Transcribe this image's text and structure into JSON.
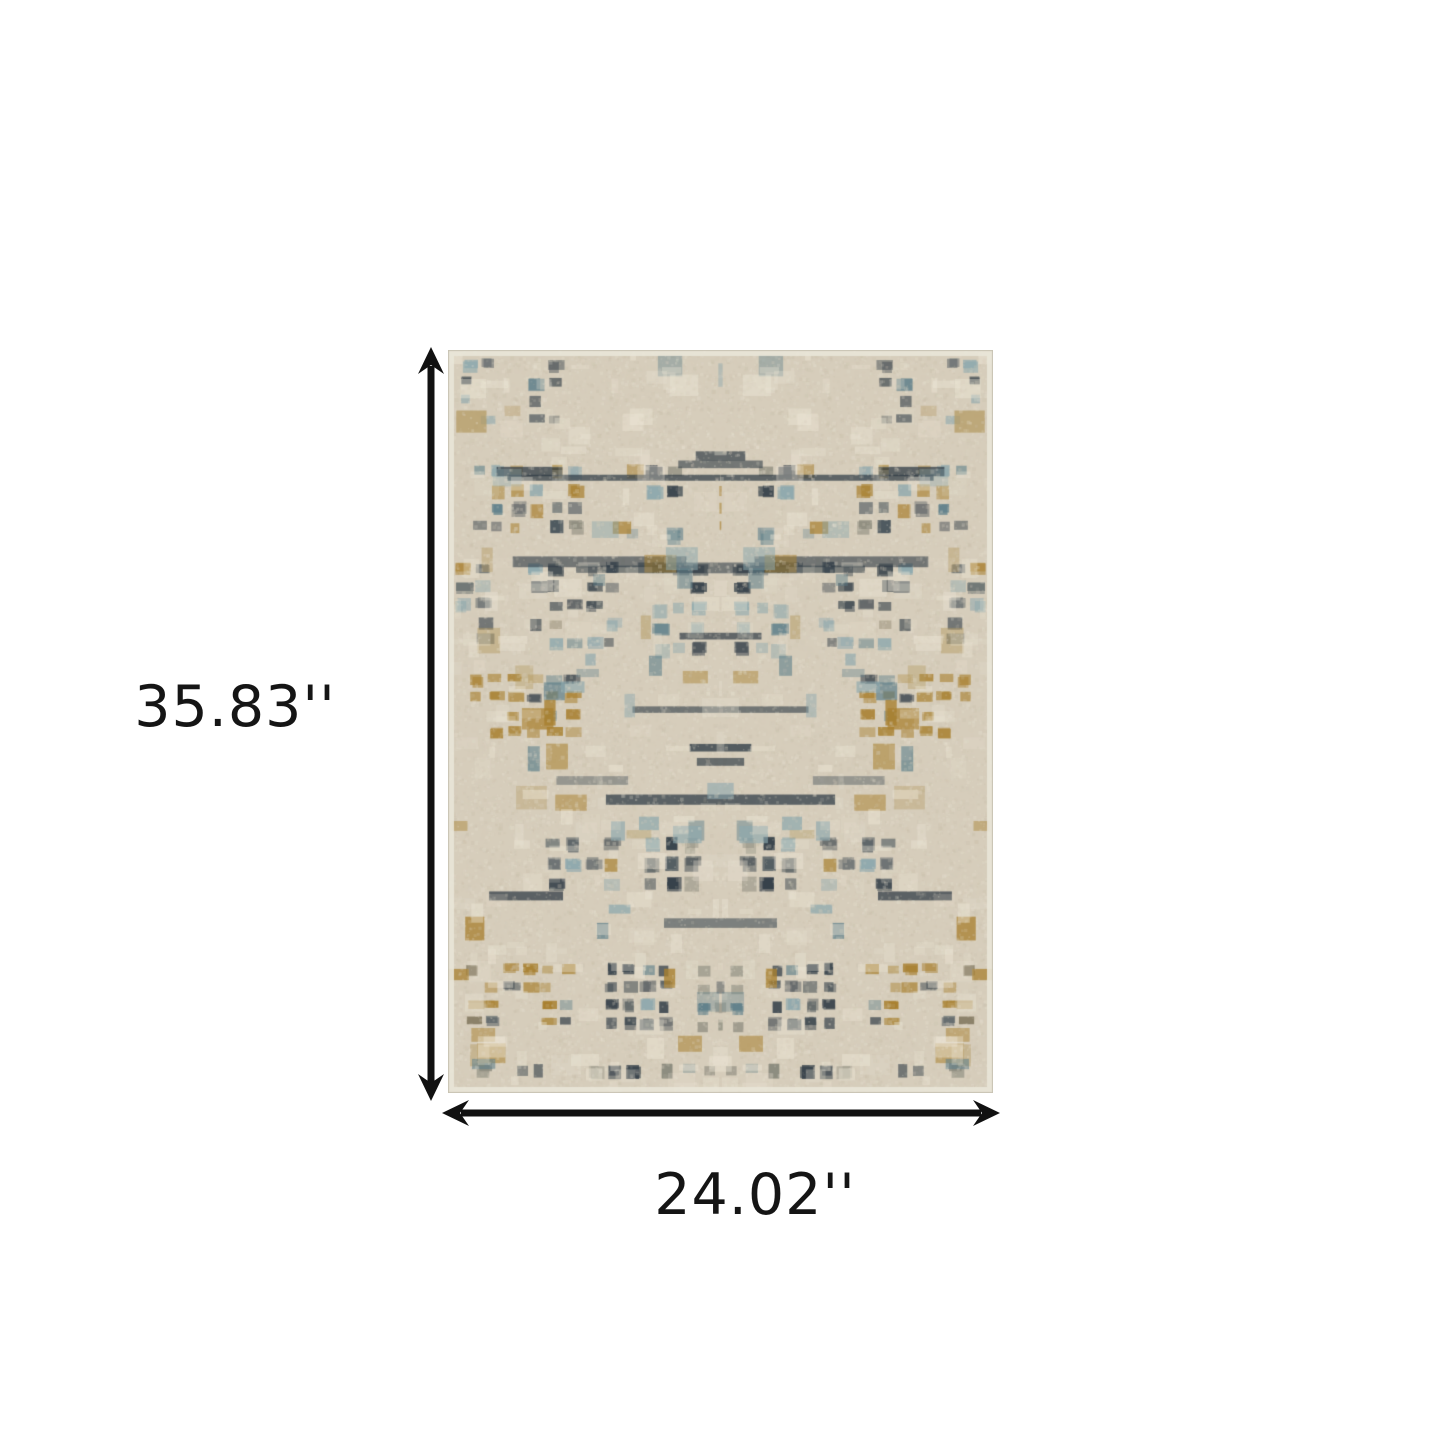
{
  "page": {
    "background": "#ffffff",
    "kind": "product-dimension-diagram"
  },
  "dimensions": {
    "height_label": "35.83''",
    "width_label": "24.02''",
    "arrow_color": "#111111"
  },
  "rug": {
    "alt": "Beige abstract distressed plaid area rug with navy, blue, grey and gold accents",
    "width": 545,
    "height": 743,
    "seed": 1337,
    "palette": {
      "base": "#d6cdbb",
      "base_light": "#e8e2d2",
      "base_dark": "#c6bca6",
      "cream": "#efe9d9",
      "navy": "#2f3b45",
      "charcoal": "#4a555c",
      "steel_blue": "#5e7f8a",
      "slate_blue": "#8ba7ad",
      "gold": "#a8802f",
      "tan": "#b49a62",
      "grey": "#8a897c",
      "brown": "#6f6349",
      "edge": "#e9e5d8",
      "edge_line": "#b3ab9b"
    },
    "color_weights": [
      [
        "navy",
        0.4
      ],
      [
        "charcoal",
        0.1
      ],
      [
        "steel_blue",
        0.13
      ],
      [
        "slate_blue",
        0.12
      ],
      [
        "gold",
        0.1
      ],
      [
        "grey",
        0.08
      ],
      [
        "brown",
        0.07
      ]
    ]
  }
}
